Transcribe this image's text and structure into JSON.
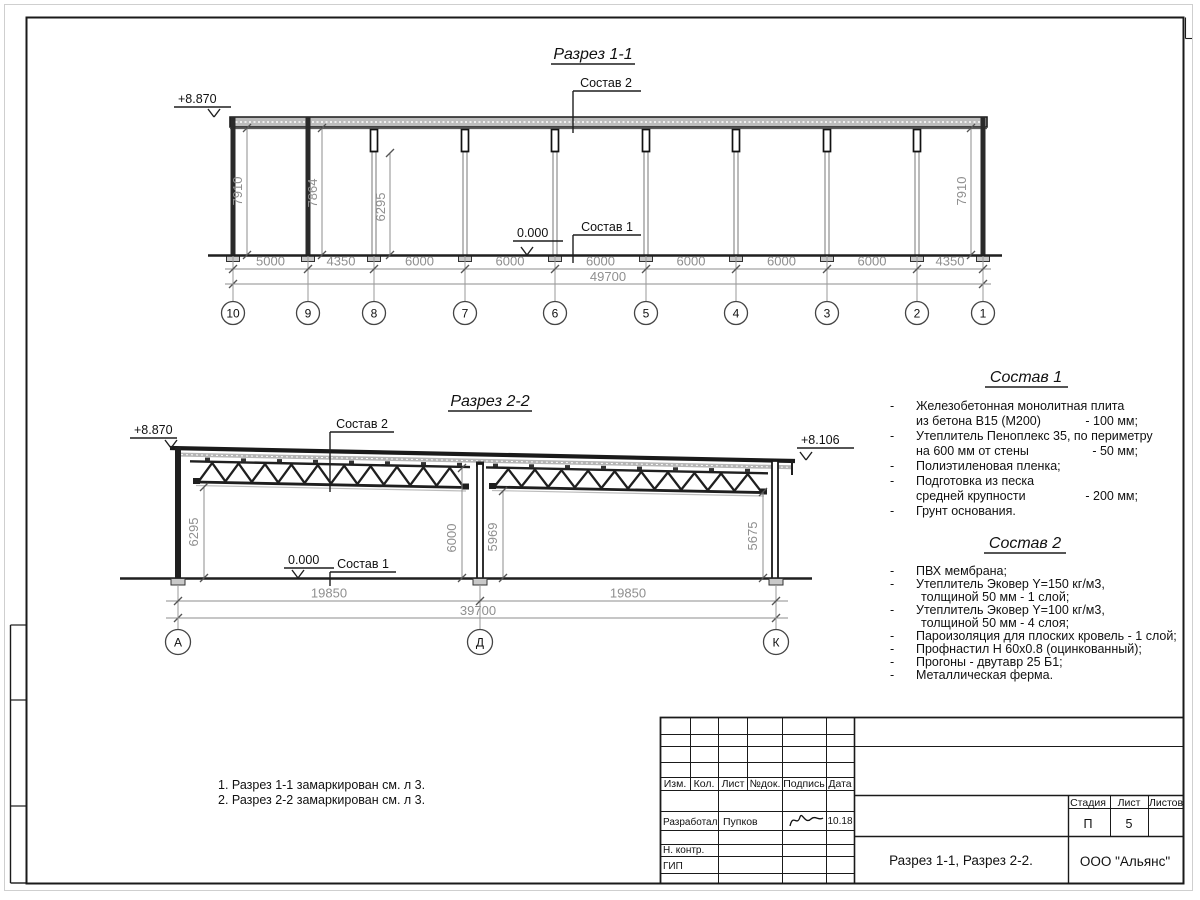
{
  "drawing1": {
    "title": "Разрез 1-1",
    "elevation_left": "+8.870",
    "zero": "0.000",
    "sostav2_label": "Состав 2",
    "sostav1_label": "Состав 1",
    "height_dims": [
      "7910",
      "7864",
      "6295",
      "7910"
    ],
    "span_dims": [
      "5000",
      "4350",
      "6000",
      "6000",
      "6000",
      "6000",
      "6000",
      "6000",
      "4350"
    ],
    "total": "49700",
    "axes": [
      "10",
      "9",
      "8",
      "7",
      "6",
      "5",
      "4",
      "3",
      "2",
      "1"
    ]
  },
  "drawing2": {
    "title": "Разрез 2-2",
    "elevation_left": "+8.870",
    "elevation_right": "+8.106",
    "zero": "0.000",
    "sostav2_label": "Состав 2",
    "sostav1_label": "Состав 1",
    "height_dims": [
      "6295",
      "6000",
      "5969",
      "5675"
    ],
    "span_dims": [
      "19850",
      "19850"
    ],
    "total": "39700",
    "axes": [
      "А",
      "Д",
      "К"
    ]
  },
  "sostav1": {
    "title": "Состав 1",
    "items": [
      {
        "dash": true,
        "text": "Железобетонная  монолитная плита",
        "value": ""
      },
      {
        "dash": false,
        "text": "из бетона В15 (М200)",
        "value": "- 100 мм;"
      },
      {
        "dash": true,
        "text": "Утеплитель Пеноплекс 35, по периметру",
        "value": ""
      },
      {
        "dash": false,
        "text": "на 600 мм от стены",
        "value": "- 50 мм;"
      },
      {
        "dash": true,
        "text": "Полиэтиленовая пленка;",
        "value": ""
      },
      {
        "dash": true,
        "text": "Подготовка из песка",
        "value": ""
      },
      {
        "dash": false,
        "text": "средней крупности",
        "value": "- 200 мм;"
      },
      {
        "dash": true,
        "text": "Грунт основания.",
        "value": ""
      }
    ]
  },
  "sostav2": {
    "title": "Состав 2",
    "items": [
      {
        "dash": true,
        "indent": false,
        "text": "ПВХ мембрана;",
        "value": ""
      },
      {
        "dash": true,
        "indent": false,
        "text": "Утеплитель Эковер Y=150 кг/м3,",
        "value": ""
      },
      {
        "dash": false,
        "indent": true,
        "text": "толщиной 50 мм - 1 слой;",
        "value": ""
      },
      {
        "dash": true,
        "indent": false,
        "text": "Утеплитель Эковер Y=100 кг/м3,",
        "value": ""
      },
      {
        "dash": false,
        "indent": true,
        "text": "толщиной 50 мм - 4 слоя;",
        "value": ""
      },
      {
        "dash": true,
        "indent": false,
        "text": "Пароизоляция для плоских кровель - 1 слой;",
        "value": ""
      },
      {
        "dash": true,
        "indent": false,
        "text": "Профнастил Н 60х0.8 (оцинкованный);",
        "value": ""
      },
      {
        "dash": true,
        "indent": false,
        "text": "Прогоны - двутавр 25 Б1;",
        "value": ""
      },
      {
        "dash": true,
        "indent": false,
        "text": "Металлическая ферма.",
        "value": ""
      }
    ]
  },
  "notes": [
    "1. Разрез 1-1 замаркирован см. л 3.",
    "2. Разрез 2-2 замаркирован см. л 3."
  ],
  "titleblock": {
    "header": [
      "Изм.",
      "Кол.",
      "Лист",
      "№док.",
      "Подпись",
      "Дата"
    ],
    "developed_label": "Разработал",
    "developed_name": "Пупков",
    "developed_date": "10.18",
    "ncontrol_label": "Н. контр.",
    "gip_label": "ГИП",
    "stage_label": "Стадия",
    "sheet_label": "Лист",
    "sheets_label": "Листов",
    "stage": "П",
    "sheet": "5",
    "doc_title": "Разрез 1-1, Разрез 2-2.",
    "company": "ООО \"Альянс\""
  }
}
